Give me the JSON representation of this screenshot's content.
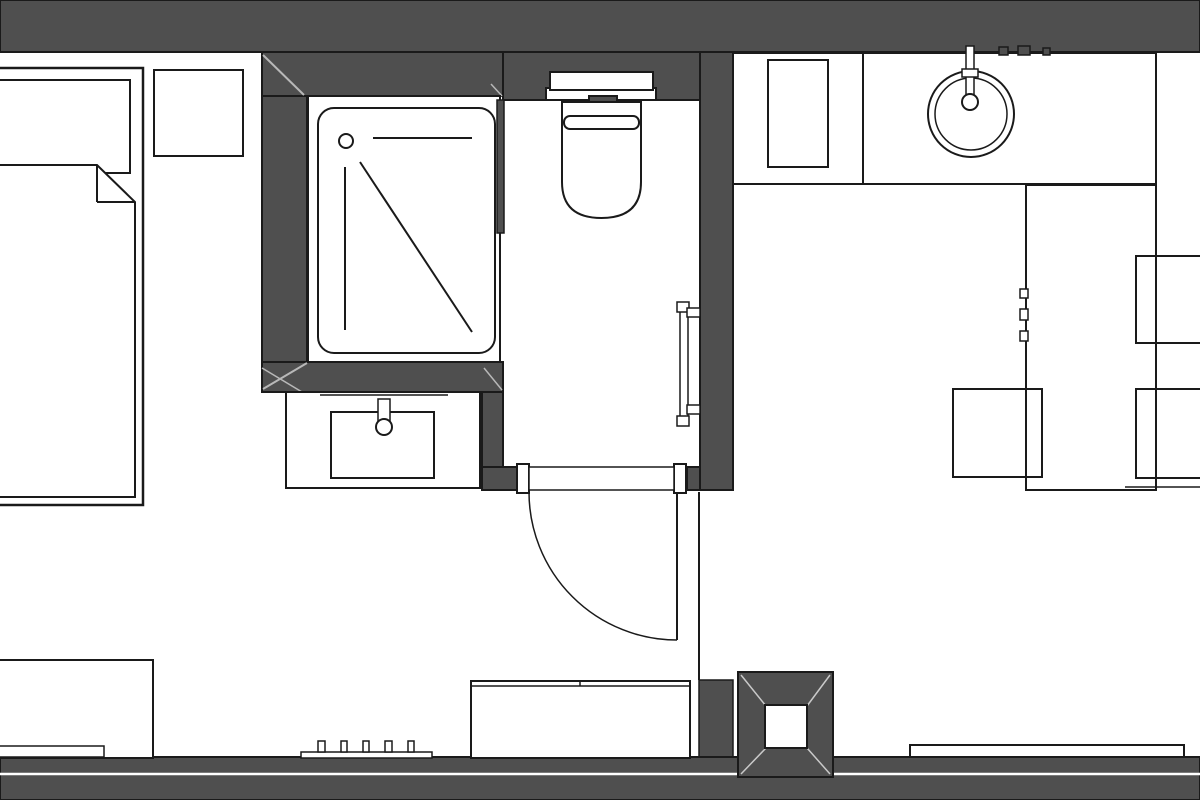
{
  "meta": {
    "title": "apartment-floor-plan",
    "canvas_width": 1200,
    "canvas_height": 800,
    "description": "Monochrome architectural floor plan: bedroom with bed and nightstand (left), shower room with vanity, WC room with toilet and towel rail (center), kitchenette with counter, round sink, table and chairs (right), furniture along bottom wall, structural column bottom-right"
  },
  "colors": {
    "background": "#ffffff",
    "wall": "#4f4f4f",
    "line": "#1a1a1a",
    "light": "#b8b8b8",
    "collight": "#c9c9c9",
    "white": "#ffffff",
    "none": "none"
  },
  "elements": [
    {
      "type": "rect",
      "name": "top-wall",
      "x": 0,
      "y": 0,
      "w": 1200,
      "h": 52,
      "fill": "wall",
      "stroke": "line",
      "sw": 2
    },
    {
      "type": "rect",
      "name": "bathroom-top-wall",
      "x": 262,
      "y": 52,
      "w": 241,
      "h": 44,
      "fill": "wall",
      "stroke": "line",
      "sw": 2
    },
    {
      "type": "rect",
      "name": "bathroom-left-wall",
      "x": 262,
      "y": 96,
      "w": 45,
      "h": 266,
      "fill": "wall",
      "stroke": "line",
      "sw": 2
    },
    {
      "type": "rect",
      "name": "bathroom-bottom-wall-band",
      "x": 262,
      "y": 362,
      "w": 241,
      "h": 30,
      "fill": "wall",
      "stroke": "line",
      "sw": 2
    },
    {
      "type": "rect",
      "name": "vanity-right-wall",
      "x": 482,
      "y": 392,
      "w": 21,
      "h": 76,
      "fill": "wall",
      "stroke": "line",
      "sw": 2
    },
    {
      "type": "rect",
      "name": "wc-top-wall",
      "x": 503,
      "y": 52,
      "w": 197,
      "h": 48,
      "fill": "wall",
      "stroke": "line",
      "sw": 2
    },
    {
      "type": "rect",
      "name": "wc-right-wall",
      "x": 700,
      "y": 52,
      "w": 33,
      "h": 438,
      "fill": "wall",
      "stroke": "line",
      "sw": 2
    },
    {
      "type": "rect",
      "name": "door-wall-left",
      "x": 482,
      "y": 467,
      "w": 36,
      "h": 23,
      "fill": "wall",
      "stroke": "line",
      "sw": 2
    },
    {
      "type": "rect",
      "name": "door-wall-right",
      "x": 687,
      "y": 467,
      "w": 13,
      "h": 23,
      "fill": "wall",
      "stroke": "line",
      "sw": 2
    },
    {
      "type": "rect",
      "name": "bottom-wall-stub",
      "x": 699,
      "y": 680,
      "w": 34,
      "h": 97,
      "fill": "wall",
      "stroke": "line",
      "sw": 1.5
    },
    {
      "type": "rect",
      "name": "bottom-wall",
      "x": 0,
      "y": 757,
      "w": 1200,
      "h": 43,
      "fill": "wall",
      "stroke": "line",
      "sw": 2
    },
    {
      "type": "line",
      "name": "bottom-wall-slot-line",
      "x1": 0,
      "y1": 774,
      "x2": 1200,
      "y2": 774,
      "stroke": "white",
      "sw": 2.5
    },
    {
      "type": "line",
      "name": "wall-miter-top-left",
      "x1": 263,
      "y1": 55,
      "x2": 304,
      "y2": 95,
      "stroke": "light",
      "sw": 2
    },
    {
      "type": "line",
      "name": "wall-miter-top-right",
      "x1": 491,
      "y1": 84,
      "x2": 502,
      "y2": 96,
      "stroke": "light",
      "sw": 1.5
    },
    {
      "type": "line",
      "name": "wall-miter-bottom-left-a",
      "x1": 307,
      "y1": 363,
      "x2": 263,
      "y2": 389,
      "stroke": "light",
      "sw": 2
    },
    {
      "type": "line",
      "name": "wall-miter-bottom-left-b",
      "x1": 262,
      "y1": 368,
      "x2": 302,
      "y2": 392,
      "stroke": "light",
      "sw": 1.5
    },
    {
      "type": "line",
      "name": "wall-miter-band-right",
      "x1": 484,
      "y1": 368,
      "x2": 502,
      "y2": 390,
      "stroke": "light",
      "sw": 1.5
    },
    {
      "type": "rect",
      "name": "bed-frame",
      "x": -8,
      "y": 68,
      "w": 151,
      "h": 437,
      "fill": "white",
      "stroke": "line",
      "sw": 2.5
    },
    {
      "type": "rect",
      "name": "bed-pillow",
      "x": -8,
      "y": 80,
      "w": 138,
      "h": 93,
      "fill": "white",
      "stroke": "line",
      "sw": 2
    },
    {
      "type": "polygon",
      "name": "bed-blanket",
      "points": "-8,165 97,165 135,202 135,497 -8,497",
      "fill": "white",
      "stroke": "line",
      "sw": 2
    },
    {
      "type": "line",
      "name": "bed-blanket-fold-vertical",
      "x1": 97,
      "y1": 165,
      "x2": 97,
      "y2": 202,
      "stroke": "line",
      "sw": 2
    },
    {
      "type": "line",
      "name": "bed-blanket-fold-horizontal",
      "x1": 97,
      "y1": 202,
      "x2": 135,
      "y2": 202,
      "stroke": "line",
      "sw": 2
    },
    {
      "type": "rect",
      "name": "nightstand",
      "x": 154,
      "y": 70,
      "w": 89,
      "h": 86,
      "fill": "white",
      "stroke": "line",
      "sw": 2
    },
    {
      "type": "rect",
      "name": "shower-enclosure",
      "x": 308,
      "y": 96,
      "w": 192,
      "h": 266,
      "fill": "white",
      "stroke": "line",
      "sw": 2
    },
    {
      "type": "rect",
      "name": "shower-tray",
      "x": 318,
      "y": 108,
      "w": 177,
      "h": 245,
      "rx": 16,
      "fill": "none",
      "stroke": "line",
      "sw": 2
    },
    {
      "type": "circle",
      "name": "shower-drain",
      "cx": 346,
      "cy": 141,
      "r": 7,
      "fill": "white",
      "stroke": "line",
      "sw": 2
    },
    {
      "type": "line",
      "name": "shower-head-line",
      "x1": 373,
      "y1": 138,
      "x2": 472,
      "y2": 138,
      "stroke": "line",
      "sw": 2
    },
    {
      "type": "line",
      "name": "shower-glass-diagonal",
      "x1": 360,
      "y1": 162,
      "x2": 472,
      "y2": 332,
      "stroke": "line",
      "sw": 2
    },
    {
      "type": "line",
      "name": "shower-glass-vertical",
      "x1": 345,
      "y1": 167,
      "x2": 345,
      "y2": 330,
      "stroke": "line",
      "sw": 2
    },
    {
      "type": "rect",
      "name": "shower-wc-partition",
      "x": 497,
      "y": 100,
      "w": 7,
      "h": 133,
      "fill": "wall",
      "stroke": "line",
      "sw": 1.5
    },
    {
      "type": "rect",
      "name": "vanity-countertop",
      "x": 286,
      "y": 392,
      "w": 194,
      "h": 96,
      "fill": "white",
      "stroke": "line",
      "sw": 2
    },
    {
      "type": "line",
      "name": "vanity-backsplash-line",
      "x1": 320,
      "y1": 395,
      "x2": 448,
      "y2": 395,
      "stroke": "line",
      "sw": 1.5
    },
    {
      "type": "rect",
      "name": "vanity-basin",
      "x": 331,
      "y": 412,
      "w": 103,
      "h": 66,
      "fill": "none",
      "stroke": "line",
      "sw": 2
    },
    {
      "type": "rect",
      "name": "vanity-faucet-body",
      "x": 378,
      "y": 399,
      "w": 12,
      "h": 24,
      "fill": "white",
      "stroke": "line",
      "sw": 1.5
    },
    {
      "type": "circle",
      "name": "vanity-faucet-head",
      "cx": 384,
      "cy": 427,
      "r": 8,
      "fill": "white",
      "stroke": "line",
      "sw": 2
    },
    {
      "type": "rect",
      "name": "cistern-flange",
      "x": 546,
      "y": 88,
      "w": 110,
      "h": 12,
      "fill": "white",
      "stroke": "line",
      "sw": 2
    },
    {
      "type": "rect",
      "name": "cistern-tank",
      "x": 550,
      "y": 72,
      "w": 103,
      "h": 18,
      "fill": "white",
      "stroke": "line",
      "sw": 2
    },
    {
      "type": "rect",
      "name": "flush-plate",
      "x": 589,
      "y": 96,
      "w": 28,
      "h": 8,
      "fill": "wall",
      "stroke": "line",
      "sw": 2
    },
    {
      "type": "path",
      "name": "toilet-bowl",
      "d": "M562,102 L641,102 L641,182 Q641,218 601.5,218 Q562,218 562,182 Z",
      "fill": "white",
      "stroke": "line",
      "sw": 2
    },
    {
      "type": "rect",
      "name": "toilet-seat-line",
      "x": 564,
      "y": 116,
      "w": 75,
      "h": 13,
      "rx": 6,
      "fill": "none",
      "stroke": "line",
      "sw": 2
    },
    {
      "type": "rect",
      "name": "towel-rail",
      "x": 680,
      "y": 305,
      "w": 8,
      "h": 117,
      "fill": "white",
      "stroke": "line",
      "sw": 1.5
    },
    {
      "type": "rect",
      "name": "towel-rail-cap-top",
      "x": 677,
      "y": 302,
      "w": 12,
      "h": 10,
      "fill": "white",
      "stroke": "line",
      "sw": 1.5
    },
    {
      "type": "rect",
      "name": "towel-rail-cap-bottom",
      "x": 677,
      "y": 416,
      "w": 12,
      "h": 10,
      "fill": "white",
      "stroke": "line",
      "sw": 1.5
    },
    {
      "type": "rect",
      "name": "towel-rail-bracket-top",
      "x": 687,
      "y": 308,
      "w": 13,
      "h": 9,
      "fill": "white",
      "stroke": "line",
      "sw": 1.5
    },
    {
      "type": "rect",
      "name": "towel-rail-bracket-bottom",
      "x": 687,
      "y": 405,
      "w": 13,
      "h": 9,
      "fill": "white",
      "stroke": "line",
      "sw": 1.5
    },
    {
      "type": "rect",
      "name": "door-jamb-left",
      "x": 517,
      "y": 464,
      "w": 12,
      "h": 29,
      "fill": "white",
      "stroke": "line",
      "sw": 2
    },
    {
      "type": "rect",
      "name": "door-jamb-right",
      "x": 674,
      "y": 464,
      "w": 12,
      "h": 29,
      "fill": "white",
      "stroke": "line",
      "sw": 2
    },
    {
      "type": "rect",
      "name": "door-leaf-closed",
      "x": 529,
      "y": 467,
      "w": 145,
      "h": 23,
      "fill": "white",
      "stroke": "line",
      "sw": 1.5
    },
    {
      "type": "path",
      "name": "door-swing-arc",
      "d": "M529,492 A148,148 0 0 0 677,640",
      "fill": "none",
      "stroke": "line",
      "sw": 1.5
    },
    {
      "type": "line",
      "name": "door-leaf-open",
      "x1": 677,
      "y1": 492,
      "x2": 677,
      "y2": 640,
      "stroke": "line",
      "sw": 2
    },
    {
      "type": "line",
      "name": "partition-line",
      "x1": 699,
      "y1": 492,
      "x2": 699,
      "y2": 680,
      "stroke": "line",
      "sw": 2
    },
    {
      "type": "rect",
      "name": "kitchen-counter",
      "x": 733,
      "y": 53,
      "w": 423,
      "h": 131,
      "fill": "white",
      "stroke": "line",
      "sw": 2
    },
    {
      "type": "line",
      "name": "kitchen-counter-divider",
      "x1": 863,
      "y1": 53,
      "x2": 863,
      "y2": 184,
      "stroke": "line",
      "sw": 2
    },
    {
      "type": "rect",
      "name": "kitchen-appliance",
      "x": 768,
      "y": 60,
      "w": 60,
      "h": 107,
      "fill": "none",
      "stroke": "line",
      "sw": 2
    },
    {
      "type": "circle",
      "name": "kitchen-sink-outer",
      "cx": 971,
      "cy": 114,
      "r": 43,
      "fill": "white",
      "stroke": "line",
      "sw": 2
    },
    {
      "type": "circle",
      "name": "kitchen-sink-inner",
      "cx": 971,
      "cy": 114,
      "r": 36,
      "fill": "none",
      "stroke": "line",
      "sw": 1.5
    },
    {
      "type": "rect",
      "name": "kitchen-faucet-stem",
      "x": 966,
      "y": 46,
      "w": 8,
      "h": 50,
      "fill": "white",
      "stroke": "line",
      "sw": 1.5
    },
    {
      "type": "rect",
      "name": "kitchen-faucet-bar",
      "x": 962,
      "y": 69,
      "w": 16,
      "h": 8,
      "fill": "white",
      "stroke": "line",
      "sw": 1.5
    },
    {
      "type": "circle",
      "name": "kitchen-faucet-head",
      "cx": 970,
      "cy": 102,
      "r": 8,
      "fill": "white",
      "stroke": "line",
      "sw": 2
    },
    {
      "type": "rect",
      "name": "wall-switch-1",
      "x": 999,
      "y": 47,
      "w": 9,
      "h": 8,
      "fill": "wall",
      "stroke": "line",
      "sw": 1.5
    },
    {
      "type": "rect",
      "name": "wall-switch-2",
      "x": 1018,
      "y": 46,
      "w": 12,
      "h": 9,
      "fill": "wall",
      "stroke": "line",
      "sw": 1.5
    },
    {
      "type": "rect",
      "name": "wall-switch-3",
      "x": 1043,
      "y": 48,
      "w": 7,
      "h": 7,
      "fill": "wall",
      "stroke": "line",
      "sw": 1.5
    },
    {
      "type": "rect",
      "name": "dining-table",
      "x": 1026,
      "y": 185,
      "w": 130,
      "h": 305,
      "fill": "white",
      "stroke": "line",
      "sw": 2
    },
    {
      "type": "rect",
      "name": "table-handle-1",
      "x": 1020,
      "y": 289,
      "w": 8,
      "h": 9,
      "fill": "white",
      "stroke": "line",
      "sw": 1.5
    },
    {
      "type": "rect",
      "name": "table-handle-2",
      "x": 1020,
      "y": 309,
      "w": 8,
      "h": 11,
      "fill": "white",
      "stroke": "line",
      "sw": 1.5
    },
    {
      "type": "rect",
      "name": "table-handle-3",
      "x": 1020,
      "y": 331,
      "w": 8,
      "h": 10,
      "fill": "white",
      "stroke": "line",
      "sw": 1.5
    },
    {
      "type": "rect",
      "name": "chair-top-right",
      "x": 1136,
      "y": 256,
      "w": 70,
      "h": 87,
      "fill": "none",
      "stroke": "line",
      "sw": 2
    },
    {
      "type": "rect",
      "name": "chair-bottom-right",
      "x": 1136,
      "y": 389,
      "w": 70,
      "h": 89,
      "fill": "none",
      "stroke": "line",
      "sw": 2
    },
    {
      "type": "rect",
      "name": "chair-bottom-left",
      "x": 953,
      "y": 389,
      "w": 89,
      "h": 88,
      "fill": "none",
      "stroke": "line",
      "sw": 2
    },
    {
      "type": "line",
      "name": "floor-line-right",
      "x1": 1125,
      "y1": 487,
      "x2": 1200,
      "y2": 487,
      "stroke": "line",
      "sw": 1.5
    },
    {
      "type": "rect",
      "name": "sideboard",
      "x": -8,
      "y": 660,
      "w": 161,
      "h": 98,
      "fill": "white",
      "stroke": "line",
      "sw": 2
    },
    {
      "type": "rect",
      "name": "sideboard-shelf",
      "x": -8,
      "y": 746,
      "w": 112,
      "h": 11,
      "fill": "white",
      "stroke": "line",
      "sw": 1.5
    },
    {
      "type": "rect",
      "name": "radiator-base",
      "x": 301,
      "y": 752,
      "w": 131,
      "h": 6,
      "fill": "white",
      "stroke": "line",
      "sw": 1.5
    },
    {
      "type": "rect",
      "name": "radiator-tick-1",
      "x": 318,
      "y": 741,
      "w": 7,
      "h": 11,
      "fill": "white",
      "stroke": "line",
      "sw": 1.5
    },
    {
      "type": "rect",
      "name": "radiator-tick-2",
      "x": 341,
      "y": 741,
      "w": 6,
      "h": 11,
      "fill": "white",
      "stroke": "line",
      "sw": 1.5
    },
    {
      "type": "rect",
      "name": "radiator-tick-3",
      "x": 363,
      "y": 741,
      "w": 6,
      "h": 11,
      "fill": "white",
      "stroke": "line",
      "sw": 1.5
    },
    {
      "type": "rect",
      "name": "radiator-tick-4",
      "x": 385,
      "y": 741,
      "w": 7,
      "h": 11,
      "fill": "white",
      "stroke": "line",
      "sw": 1.5
    },
    {
      "type": "rect",
      "name": "radiator-tick-5",
      "x": 408,
      "y": 741,
      "w": 6,
      "h": 11,
      "fill": "white",
      "stroke": "line",
      "sw": 1.5
    },
    {
      "type": "rect",
      "name": "bottom-cabinet",
      "x": 471,
      "y": 681,
      "w": 219,
      "h": 77,
      "fill": "white",
      "stroke": "line",
      "sw": 2
    },
    {
      "type": "line",
      "name": "bottom-cabinet-top-line",
      "x1": 471,
      "y1": 686,
      "x2": 690,
      "y2": 686,
      "stroke": "line",
      "sw": 1.5
    },
    {
      "type": "line",
      "name": "bottom-cabinet-tick",
      "x1": 580,
      "y1": 681,
      "x2": 580,
      "y2": 686,
      "stroke": "line",
      "sw": 1.5
    },
    {
      "type": "rect",
      "name": "window-ledge",
      "x": 910,
      "y": 745,
      "w": 274,
      "h": 12,
      "fill": "white",
      "stroke": "line",
      "sw": 2
    },
    {
      "type": "rect",
      "name": "column-outer",
      "x": 738,
      "y": 672,
      "w": 95,
      "h": 105,
      "fill": "wall",
      "stroke": "line",
      "sw": 2
    },
    {
      "type": "line",
      "name": "column-diagonal-tl",
      "x1": 741,
      "y1": 675,
      "x2": 766,
      "y2": 706,
      "stroke": "collight",
      "sw": 1.5
    },
    {
      "type": "line",
      "name": "column-diagonal-tr",
      "x1": 830,
      "y1": 675,
      "x2": 807,
      "y2": 706,
      "stroke": "collight",
      "sw": 1.5
    },
    {
      "type": "line",
      "name": "column-diagonal-bl",
      "x1": 741,
      "y1": 774,
      "x2": 766,
      "y2": 748,
      "stroke": "collight",
      "sw": 1.5
    },
    {
      "type": "line",
      "name": "column-diagonal-br",
      "x1": 830,
      "y1": 774,
      "x2": 807,
      "y2": 748,
      "stroke": "collight",
      "sw": 1.5
    },
    {
      "type": "rect",
      "name": "column-inner",
      "x": 765,
      "y": 705,
      "w": 42,
      "h": 43,
      "fill": "white",
      "stroke": "line",
      "sw": 2
    }
  ]
}
